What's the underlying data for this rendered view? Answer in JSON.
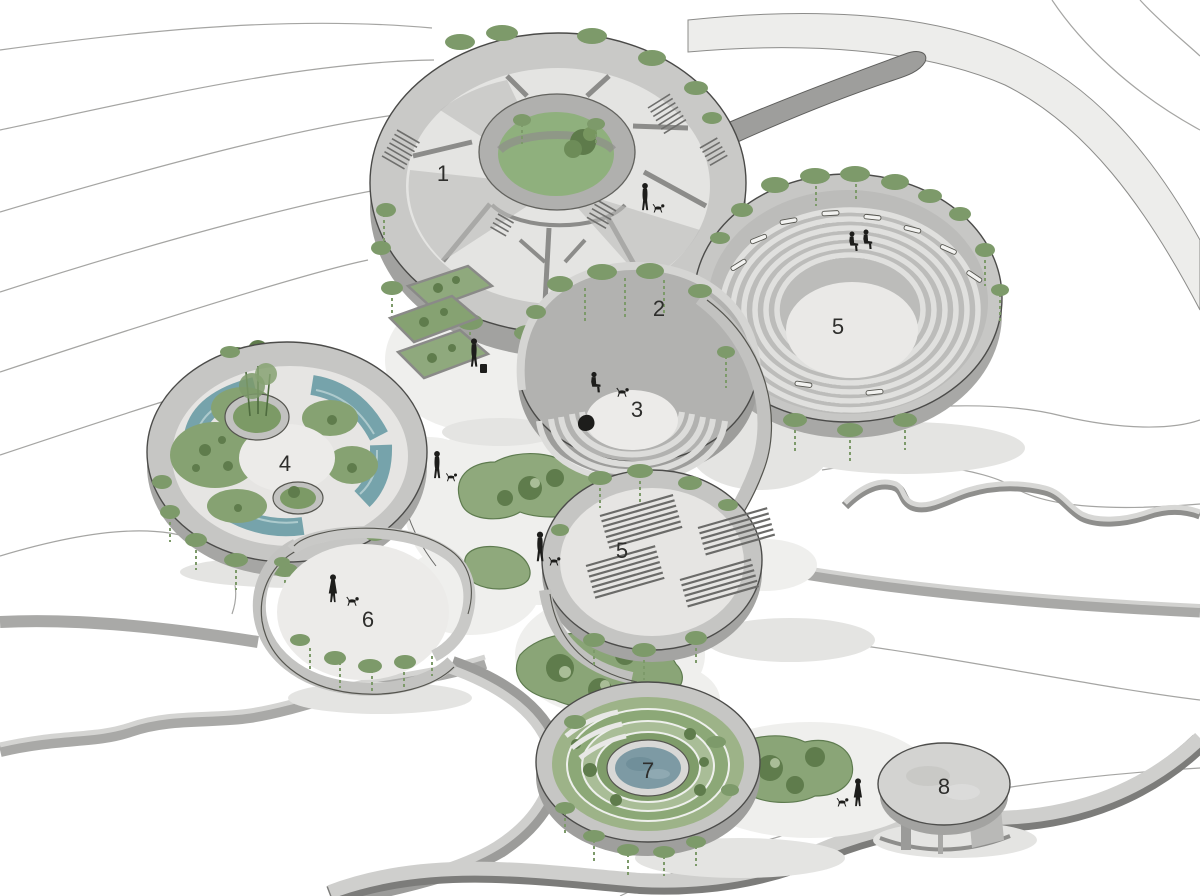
{
  "document": {
    "kind": "architectural axonometric site illustration",
    "background_color": "#ffffff"
  },
  "palette": {
    "concrete_light": "#cfcfcd",
    "concrete_mid": "#b4b4b2",
    "concrete_dark": "#8f8f8d",
    "floor_light": "#ecebe9",
    "vegetation": "#8aa577",
    "vegetation_dark": "#5f7c4c",
    "vegetation_pale": "#a9bd97",
    "water": "#76a3ab",
    "pond": "#7d9aa4",
    "contour_line": "#a5a5a3",
    "silhouette": "#1d1d1b",
    "shadow": "#e4e4e2",
    "label_color": "#2e2e2c"
  },
  "labels": [
    {
      "text": "1"
    },
    {
      "text": "2"
    },
    {
      "text": "3"
    },
    {
      "text": "4"
    },
    {
      "text": "5"
    },
    {
      "text": "5"
    },
    {
      "text": "6"
    },
    {
      "text": "7"
    },
    {
      "text": "8"
    }
  ],
  "icons": {
    "person": "black-silhouette",
    "dog": "black-silhouette",
    "tree": "green-fuzzy-circle",
    "vines": "green-hanging-clumps",
    "stairs": "parallel-step-lines"
  },
  "figures": {
    "people": [
      {
        "pose": "standing",
        "with_dog": true
      },
      {
        "pose": "sitting-pair",
        "with_dog": false
      },
      {
        "pose": "sitting",
        "with_dog": true
      },
      {
        "pose": "standing-with-case",
        "with_dog": false
      },
      {
        "pose": "standing",
        "with_dog": true
      },
      {
        "pose": "walking",
        "with_dog": true
      },
      {
        "pose": "walking-dress",
        "with_dog": true
      },
      {
        "pose": "walking-dress",
        "with_dog": true
      }
    ]
  }
}
